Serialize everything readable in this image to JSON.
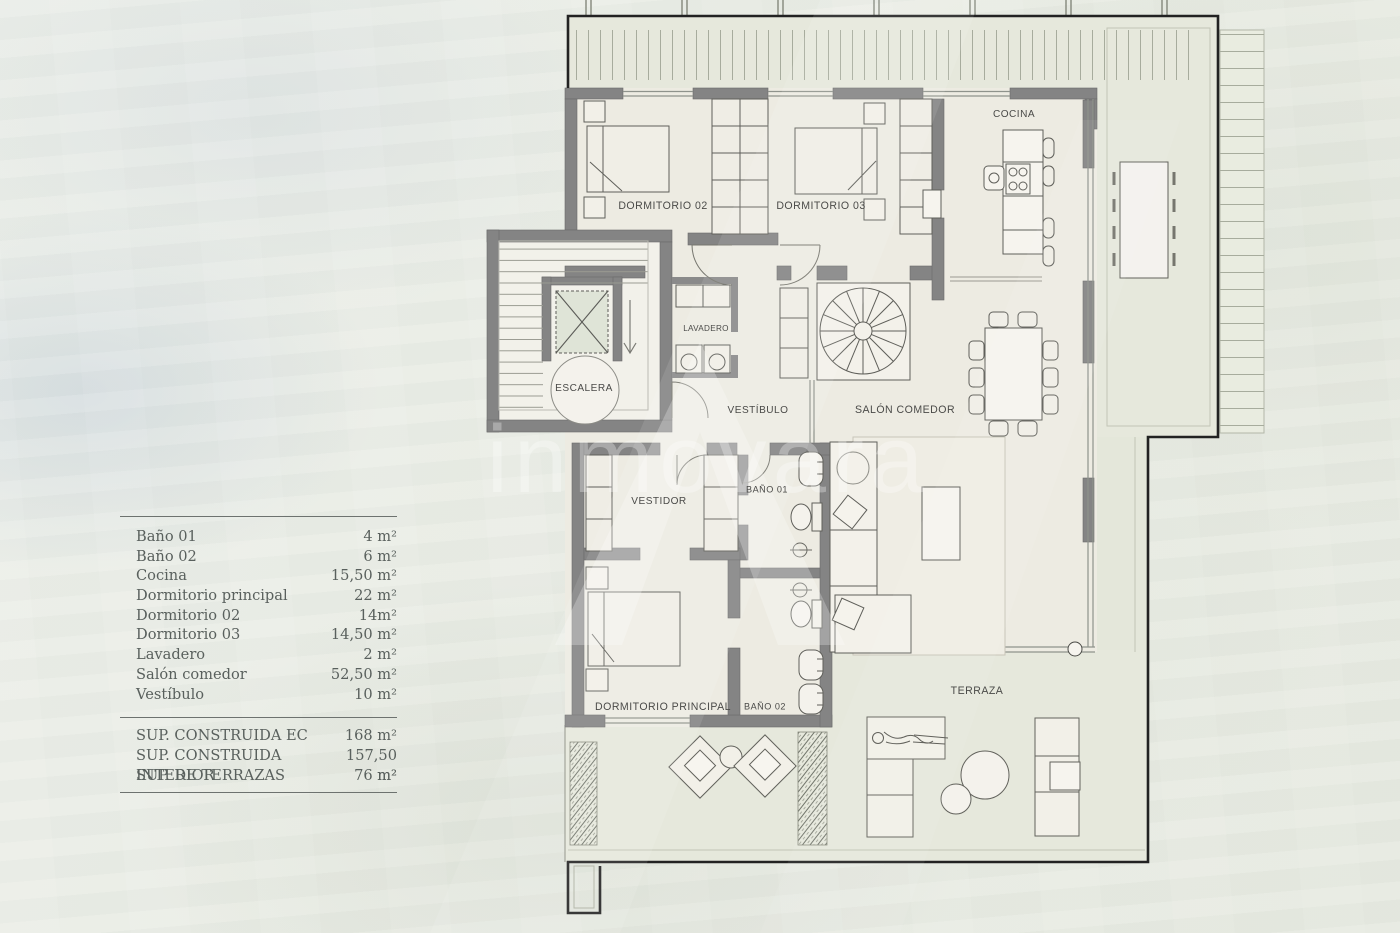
{
  "watermark": {
    "text": "inmovara"
  },
  "legend": {
    "rooms": [
      {
        "name": "Baño 01",
        "value": "4 m²"
      },
      {
        "name": "Baño 02",
        "value": "6 m²"
      },
      {
        "name": "Cocina",
        "value": "15,50 m²"
      },
      {
        "name": "Dormitorio principal",
        "value": "22 m²"
      },
      {
        "name": "Dormitorio 02",
        "value": "14m²"
      },
      {
        "name": "Dormitorio 03",
        "value": "14,50 m²"
      },
      {
        "name": "Lavadero",
        "value": "2 m²"
      },
      {
        "name": "Salón comedor",
        "value": "52,50 m²"
      },
      {
        "name": "Vestíbulo",
        "value": "10 m²"
      }
    ],
    "totals": [
      {
        "name": "SUP. CONSTRUIDA EC",
        "value": "168 m²"
      },
      {
        "name": "SUP. CONSTRUIDA INTERIOR",
        "value": "157,50 m²"
      },
      {
        "name": "SUP. DE TERRAZAS",
        "value": "76 m²"
      }
    ]
  },
  "plan": {
    "labels": {
      "dormitorio02": "DORMITORIO 02",
      "dormitorio03": "DORMITORIO 03",
      "cocina": "COCINA",
      "escalera": "ESCALERA",
      "lavadero": "LAVADERO",
      "vestibulo": "VESTÍBULO",
      "salon_comedor": "SALÓN COMEDOR",
      "vestidor": "VESTIDOR",
      "bano01": "BAÑO 01",
      "dormitorio_principal": "DORMITORIO PRINCIPAL",
      "bano02": "BAÑO 02",
      "terraza": "TERRAZA"
    }
  },
  "colors": {
    "wall": "#848484",
    "interior_floor": "#edebe2",
    "terrace_floor": "#e6e8dc",
    "boundary": "#222222",
    "background": "#e9ece4"
  }
}
